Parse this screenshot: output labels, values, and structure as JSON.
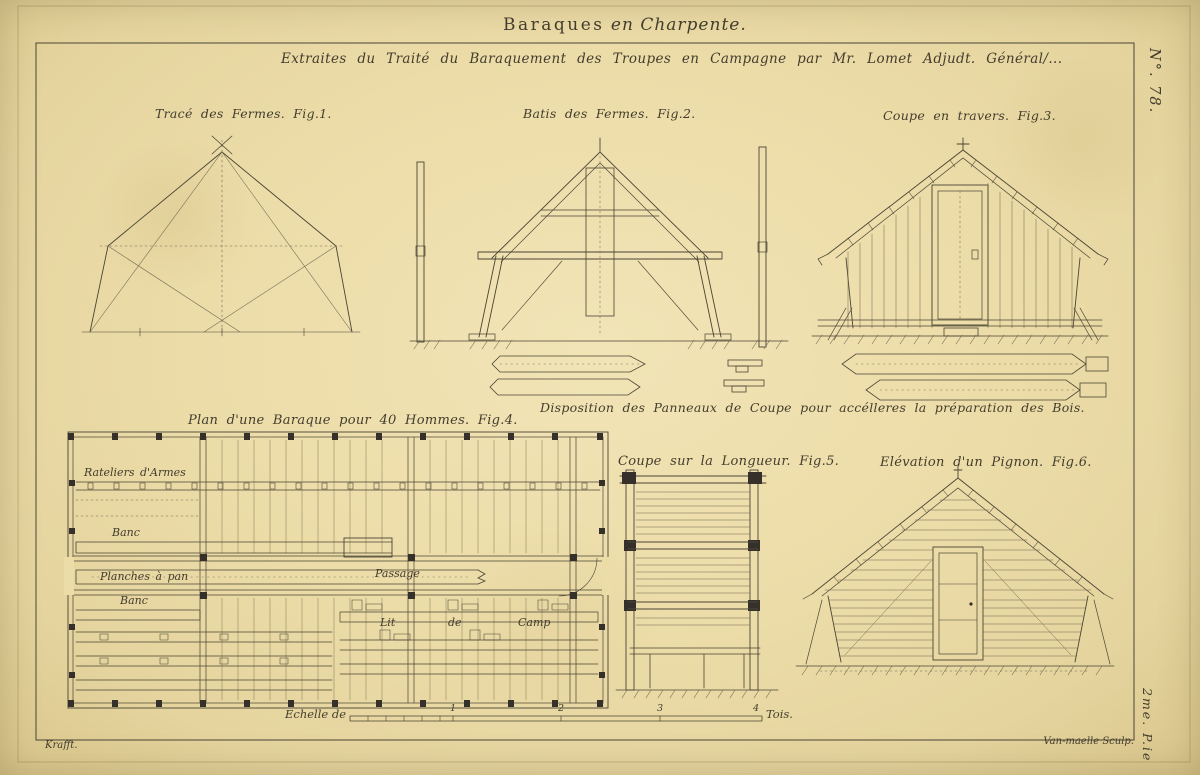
{
  "plate": {
    "title_main": "Baraques",
    "title_rest": " en Charpente.",
    "subtitle": "Extraites du Traité du Baraquement des Troupes en Campagne par Mr. Lomet Adjudt. Général/...",
    "number": "N°. 78.",
    "part": "2me. P.ie",
    "sig_left": "Krafft.",
    "sig_right": "Van-maelle Sculp."
  },
  "captions": {
    "fig1": "Tracé des Fermes. Fig.1.",
    "fig2": "Batis des Fermes. Fig.2.",
    "fig3": "Coupe en travers. Fig.3.",
    "panels": "Disposition des Panneaux de Coupe pour accélleres la préparation des Bois.",
    "fig4": "Plan d'une Baraque pour 40 Hommes. Fig.4.",
    "fig5": "Coupe sur la Longueur. Fig.5.",
    "fig6": "Elévation d'un Pignon. Fig.6."
  },
  "plan_labels": {
    "racks": "Rateliers d'Armes",
    "bench_top": "Banc",
    "planks": "Planches à pan",
    "bench_bottom": "Banc",
    "passage": "Passage",
    "lit": "Lit",
    "de": "de",
    "camp": "Camp"
  },
  "scale": {
    "label": "Echelle de",
    "ticks": [
      "1",
      "2",
      "3",
      "4"
    ],
    "unit": "Tois."
  },
  "colors": {
    "paper": "#ecdca8",
    "ink": "#4b4535"
  }
}
